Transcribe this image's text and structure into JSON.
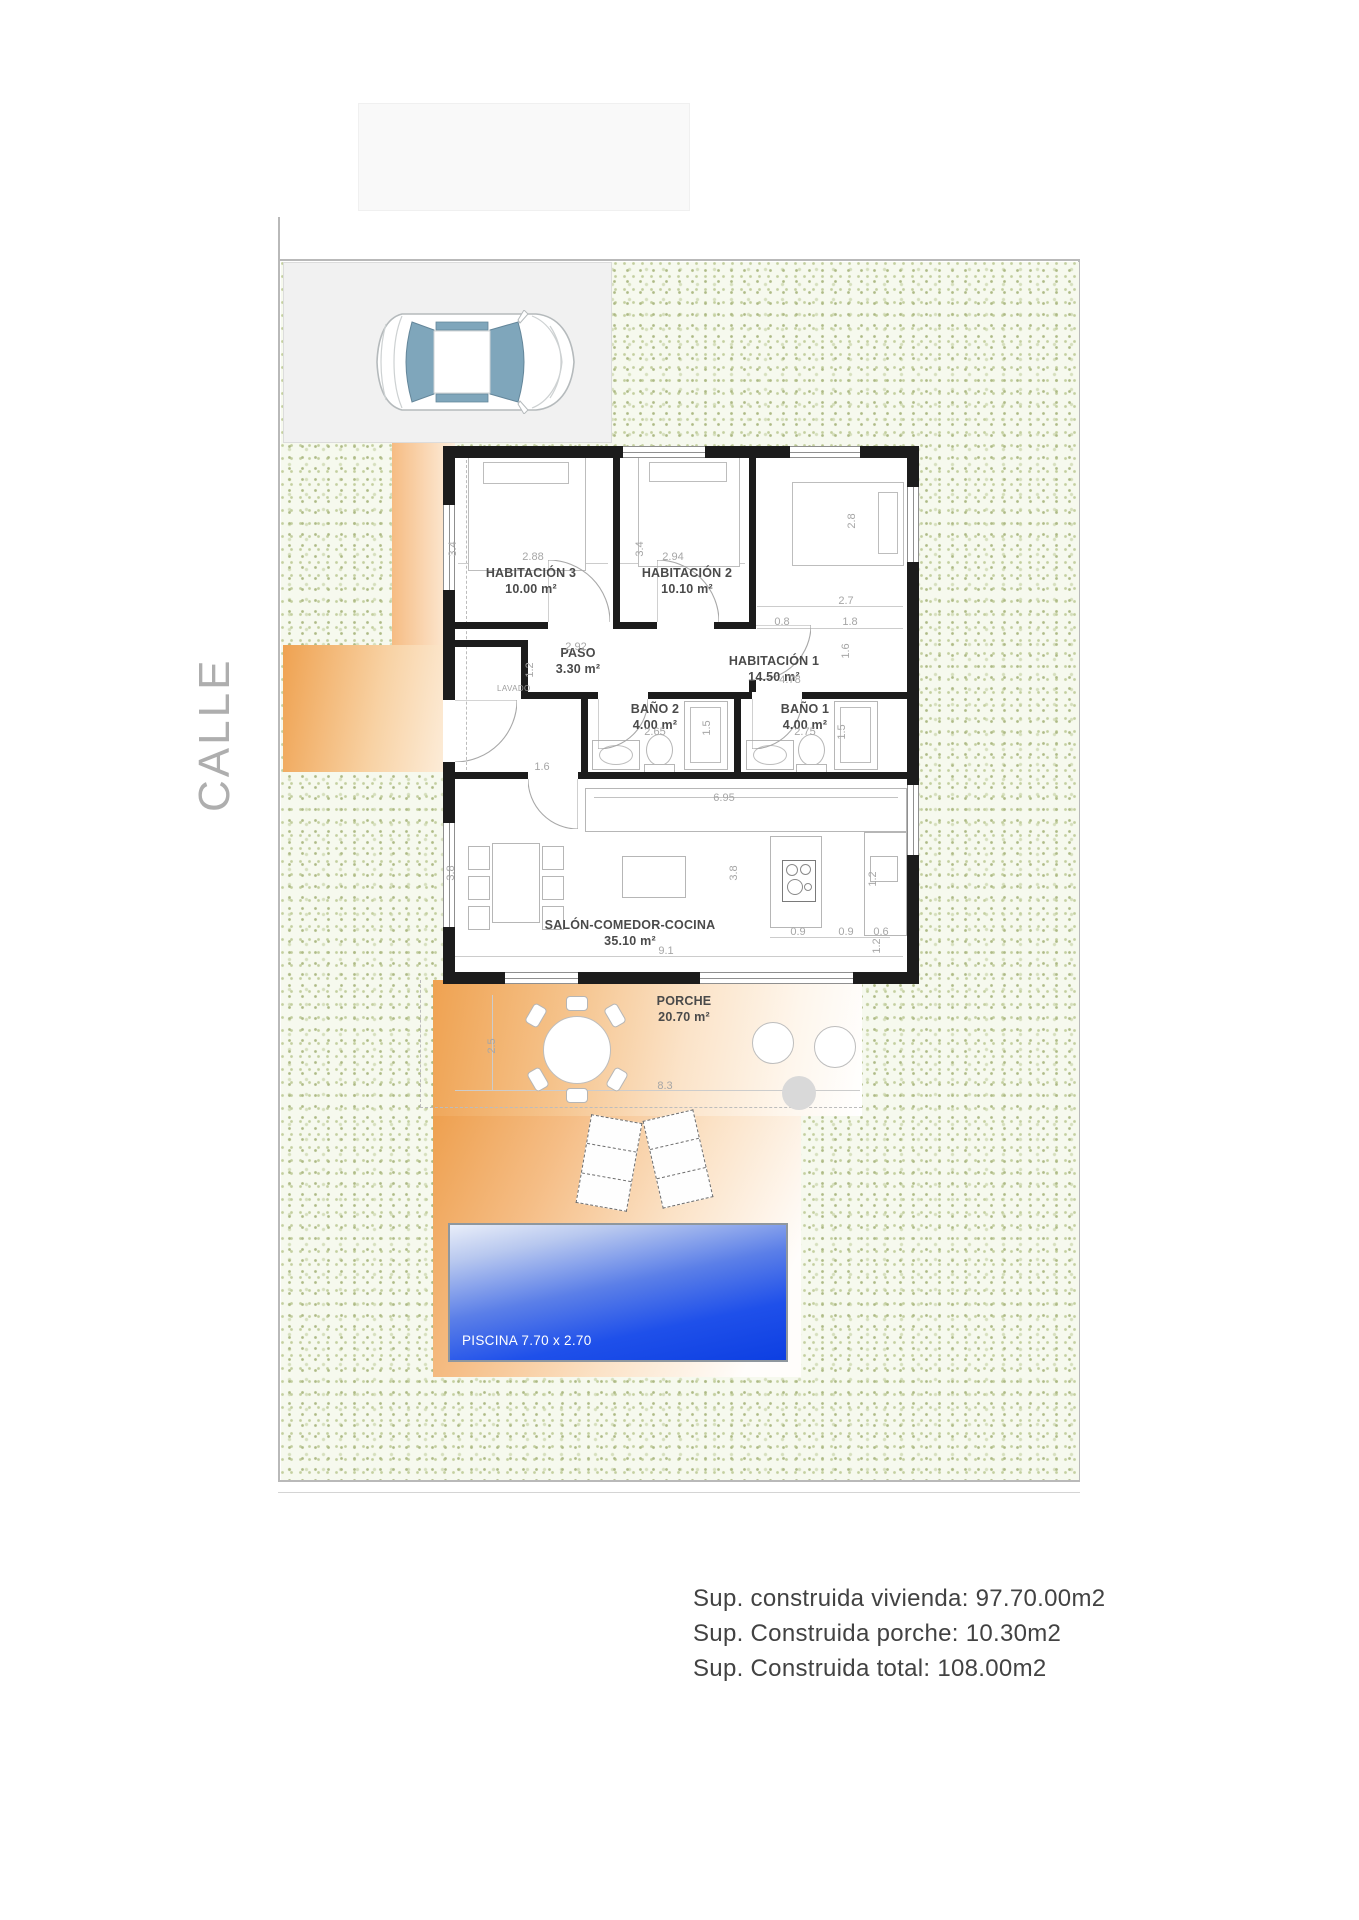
{
  "street_label": "CALLE",
  "plan": {
    "rooms": [
      {
        "name": "HABITACIÓN 3",
        "area": "10.00 m²"
      },
      {
        "name": "HABITACIÓN 2",
        "area": "10.10 m²"
      },
      {
        "name": "HABITACIÓN 1",
        "area": "14.50 m²"
      },
      {
        "name": "PASO",
        "area": "3.30 m²"
      },
      {
        "name": "BAÑO 2",
        "area": "4.00 m²"
      },
      {
        "name": "BAÑO 1",
        "area": "4.00 m²"
      },
      {
        "name": "SALÓN-COMEDOR-COCINA",
        "area": "35.10 m²"
      },
      {
        "name": "PORCHE",
        "area": "20.70 m²"
      },
      {
        "name": "LAVADO",
        "area": ""
      }
    ],
    "pool_label": "PISCINA 7.70 x 2.70",
    "dims": [
      "3.4",
      "2.88",
      "3.4",
      "2.94",
      "2.8",
      "2.7",
      "0.8",
      "1.8",
      "1.6",
      "2.92",
      "1.2",
      "2.65",
      "1.5",
      "2.75",
      "1.5",
      "4.78",
      "1.6",
      "6.95",
      "3.8",
      "3.8",
      "9.1",
      "0.9",
      "0.9",
      "0.6",
      "1.2",
      "1.2",
      "2.5",
      "8.3"
    ]
  },
  "summary": {
    "line1": "Sup. construida vivienda: 97.70.00m2",
    "line2": "Sup. Construida porche: 10.30m2",
    "line3": "Sup. Construida total: 108.00m2"
  },
  "colors": {
    "wall": "#1c1c1c",
    "garden_dot": "#aeba86",
    "porch_orange": "#efa251",
    "pool_blue": "#1f50ea",
    "glass_blue": "#7fa6bb"
  }
}
